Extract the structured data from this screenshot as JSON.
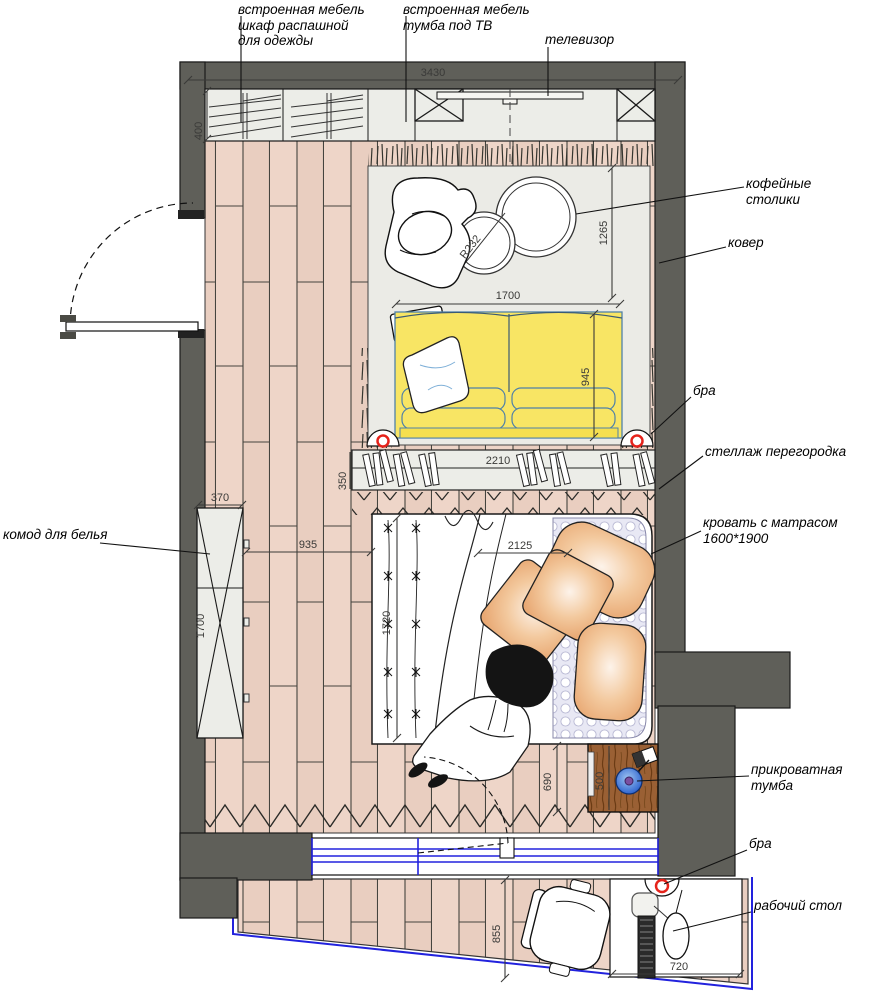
{
  "callouts": {
    "wardrobe": "встроенная мебель\nшкаф распашной\n для одежды",
    "tv_stand": "встроенная мебель\nтумба под ТВ",
    "tv": "телевизор",
    "coffee_tables": "кофейные\nстолики",
    "carpet": "ковер",
    "sconce_sofa": "бра",
    "shelving": "стеллаж перегородка",
    "bed": "кровать с матрасом\n1600*1900",
    "dresser": "комод для белья",
    "bedside_table": "прикроватная тумба",
    "sconce_desk": "бра",
    "desk": "рабочий стол"
  },
  "dims": {
    "top_width": "3430",
    "wardrobe_depth": "400",
    "carpet_length": "1265",
    "table_radius": "R232",
    "sofa_width": "1700",
    "sofa_depth": "945",
    "shelf_length": "2210",
    "shelf_depth": "350",
    "dresser_width": "370",
    "dresser_length": "1700",
    "bed_gap": "935",
    "bed_length": "2125",
    "bed_width": "1720",
    "nightstand_width": "500",
    "nightstand_gap": "690",
    "balcony_depth": "855",
    "desk_width": "720"
  },
  "colors": {
    "wall": "#5f5f59",
    "floor": "#eed5c8",
    "furniture_light": "#ecede8",
    "sofa_yellow": "#f8e564",
    "pillow_peach": "#edb488",
    "blanket_lavender": "#e8e8f4",
    "wood_brown": "#9a6034",
    "lamp_blue": "#2e6cd8",
    "sconce_red": "#e5231b",
    "window_blue": "#2222dd"
  }
}
